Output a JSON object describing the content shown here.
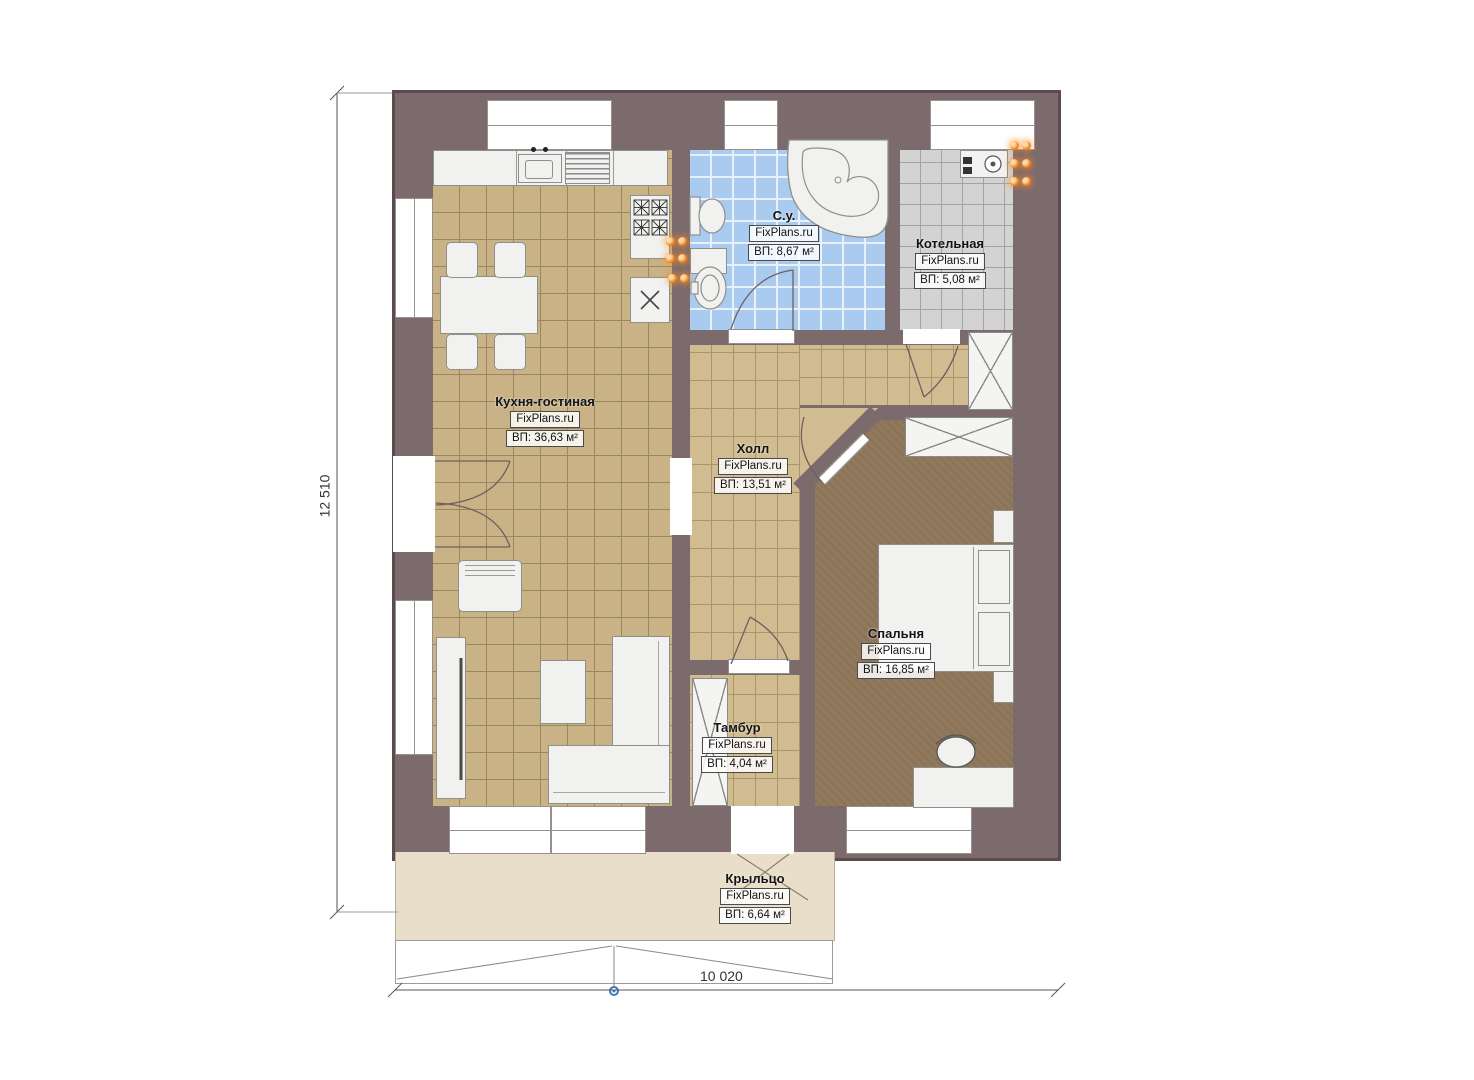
{
  "rooms": [
    {
      "id": "kitchen-living",
      "name": "Кухня-гостиная",
      "brand": "FixPlans.ru",
      "area": "ВП: 36,63 м²"
    },
    {
      "id": "bathroom",
      "name": "С.у.",
      "brand": "FixPlans.ru",
      "area": "ВП: 8,67 м²"
    },
    {
      "id": "boiler-room",
      "name": "Котельная",
      "brand": "FixPlans.ru",
      "area": "ВП: 5,08 м²"
    },
    {
      "id": "hall",
      "name": "Холл",
      "brand": "FixPlans.ru",
      "area": "ВП: 13,51 м²"
    },
    {
      "id": "bedroom",
      "name": "Спальня",
      "brand": "FixPlans.ru",
      "area": "ВП: 16,85 м²"
    },
    {
      "id": "vestibule",
      "name": "Тамбур",
      "brand": "FixPlans.ru",
      "area": "ВП: 4,04 м²"
    },
    {
      "id": "porch",
      "name": "Крыльцо",
      "brand": "FixPlans.ru",
      "area": "ВП: 6,64 м²"
    }
  ],
  "dimensions": {
    "height_label": "12 510",
    "width_label": "10 020"
  },
  "colors": {
    "wall": "#7c6b6c",
    "kitchen_floor": "#c9b286",
    "hall_floor": "#d0bc90",
    "bathroom_floor": "#aacbf0",
    "boiler_floor": "#d3d3d3",
    "bedroom_floor": "#8c7457",
    "porch_floor": "#e9dec9",
    "radiator": "#f08822",
    "entry_marker": "#3a7abf"
  },
  "fixtures": {
    "kitchen": [
      "kitchen-counter",
      "kitchen-sink",
      "dish-drainer",
      "stove",
      "prep-sink",
      "dining-table",
      "chair",
      "armchair",
      "tv-stand",
      "coffee-table",
      "corner-sofa"
    ],
    "bathroom": [
      "toilet",
      "cabinet",
      "washbasin",
      "corner-bathtub",
      "towel-radiator"
    ],
    "boiler_room": [
      "boiler-unit",
      "radiator"
    ],
    "hall": [
      "wardrobe"
    ],
    "bedroom": [
      "wardrobe",
      "double-bed",
      "nightstand",
      "desk",
      "stool"
    ],
    "vestibule": [
      "closet"
    ],
    "porch": [
      "steps",
      "entry-marker"
    ]
  }
}
